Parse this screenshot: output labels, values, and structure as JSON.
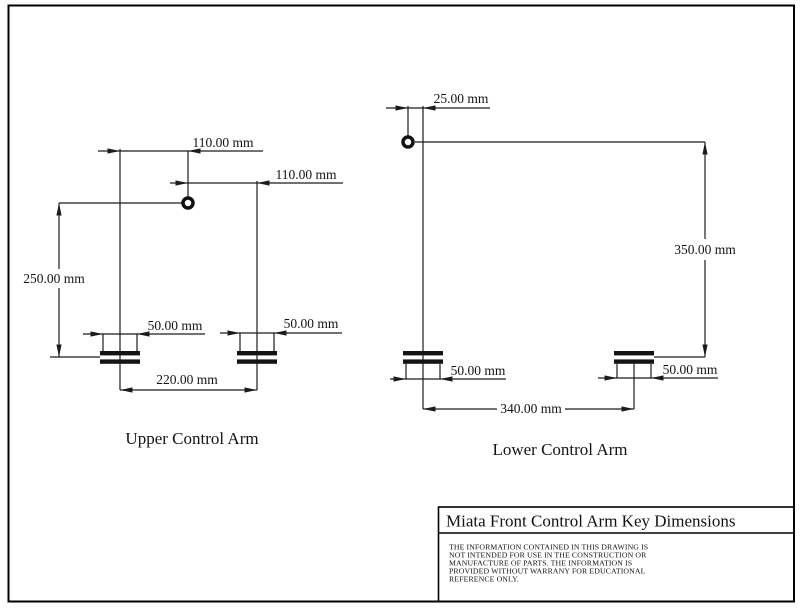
{
  "page": {
    "background": "#ffffff",
    "line_color": "#1c1c1c"
  },
  "upper_arm": {
    "label": "Upper Control Arm",
    "dim_pivot_left": "110.00 mm",
    "dim_pivot_right": "110.00 mm",
    "dim_height": "250.00 mm",
    "dim_bushing_left_width": "50.00 mm",
    "dim_bushing_right_width": "50.00 mm",
    "dim_bushing_span": "220.00 mm"
  },
  "lower_arm": {
    "label": "Lower Control Arm",
    "dim_balljoint_offset": "25.00 mm",
    "dim_height": "350.00 mm",
    "dim_bushing_left_width": "50.00 mm",
    "dim_bushing_right_width": "50.00 mm",
    "dim_bushing_span": "340.00 mm"
  },
  "title_block": {
    "title": "Miata Front Control Arm Key Dimensions",
    "disclaimer": [
      "THE INFORMATION CONTAINED IN THIS DRAWING IS",
      "NOT INTENDED FOR USE IN THE CONSTRUCTION OR",
      "MANUFACTURE OF PARTS. THE INFORMATION IS",
      "PROVIDED WITHOUT WARRANY FOR EDUCATIONAL",
      "REFERENCE ONLY."
    ]
  }
}
